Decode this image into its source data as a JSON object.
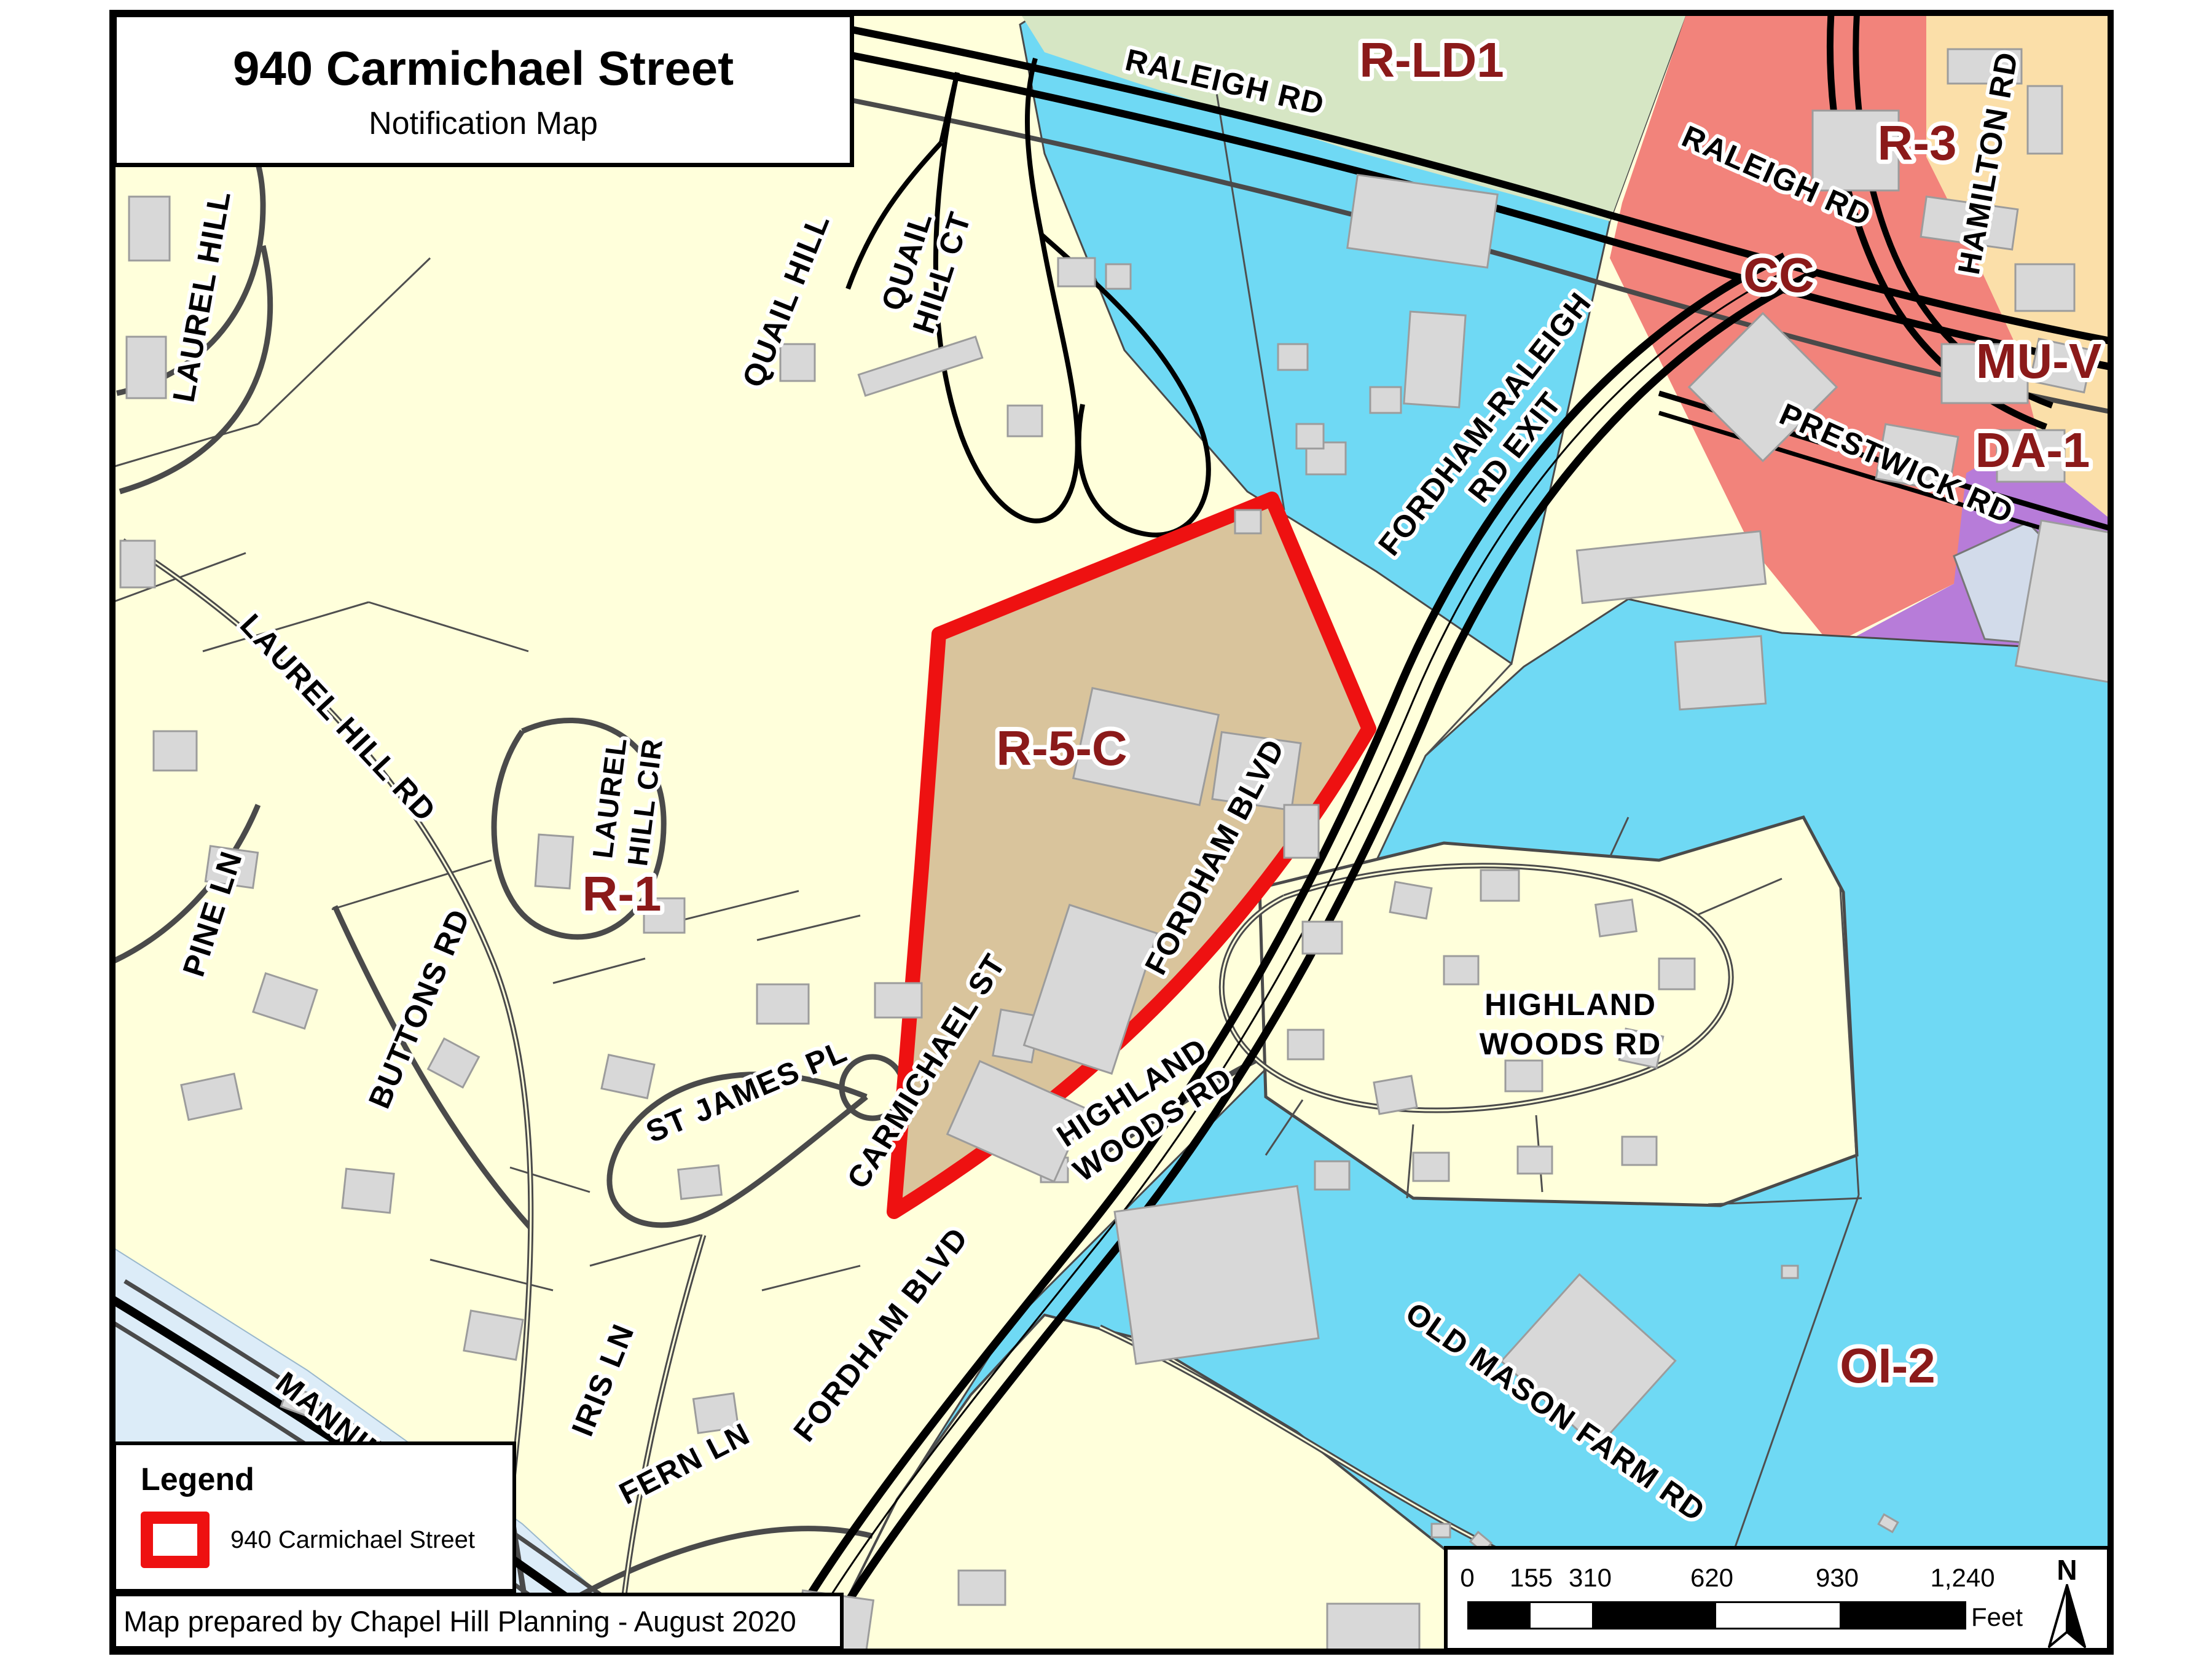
{
  "title": {
    "line1": "940 Carmichael Street",
    "line2": "Notification Map"
  },
  "legend": {
    "heading": "Legend",
    "item_label": "940 Carmichael Street"
  },
  "credit": "Map prepared by Chapel Hill Planning - August 2020",
  "scale_bar": {
    "ticks": [
      "0",
      "155",
      "310",
      "620",
      "930",
      "1,240"
    ],
    "unit": "Feet",
    "north": "N"
  },
  "zones": {
    "r_ld1": "R-LD1",
    "r_3": "R-3",
    "cc": "CC",
    "mu_v": "MU-V",
    "da_1": "DA-1",
    "r_5_c": "R-5-C",
    "r_1": "R-1",
    "oi_2": "OI-2"
  },
  "streets": {
    "raleigh_rd_west": "RALEIGH RD",
    "raleigh_rd_east": "RALEIGH RD",
    "hamilton_rd": "HAMILTON RD",
    "prestwick_rd": "PRESTWICK RD",
    "fordham_raleigh_line1": "FORDHAM-RALEIGH",
    "fordham_raleigh_line2": "RD EXIT",
    "quail_hill": "QUAIL HILL",
    "quail_hill_ct_line1": "QUAIL",
    "quail_hill_ct_line2": "HILL CT",
    "laurel_hill": "LAUREL HILL",
    "laurel_hill_rd": "LAUREL HILL RD",
    "laurel_hill_cir_line1": "LAUREL",
    "laurel_hill_cir_line2": "HILL CIR",
    "pine_ln": "PINE LN",
    "buttons_rd": "BUTTONS RD",
    "st_james_pl": "ST JAMES PL",
    "carmichael_st": "CARMICHAEL ST",
    "fordham_blvd_upper": "FORDHAM BLVD",
    "fordham_blvd_lower": "FORDHAM BLVD",
    "highland_diag_line1": "HIGHLAND",
    "highland_diag_line2": "WOODS RD",
    "highland_horiz_line1": "HIGHLAND",
    "highland_horiz_line2": "WOODS RD",
    "old_mason_farm_rd": "OLD MASON FARM RD",
    "manning": "MANNING",
    "iris_ln": "IRIS LN",
    "fern_ln": "FERN LN"
  },
  "colors": {
    "map_bg": "#FFFFDB",
    "zone_cyan": "#6FD9F4",
    "zone_green": "#D6E6C4",
    "zone_red": "#F2837B",
    "zone_orange": "#FBDFA9",
    "zone_purple": "#B77CD9",
    "zone_bluegray": "#D2DBEA",
    "water": "#DCECF8",
    "parcel_fill": "#D9C49C",
    "parcel_outline": "#EE1111",
    "zone_label": "#8B1A1A",
    "building": "#D8D8D8",
    "road_local": "#4A4A4A",
    "road_major": "#000000"
  }
}
